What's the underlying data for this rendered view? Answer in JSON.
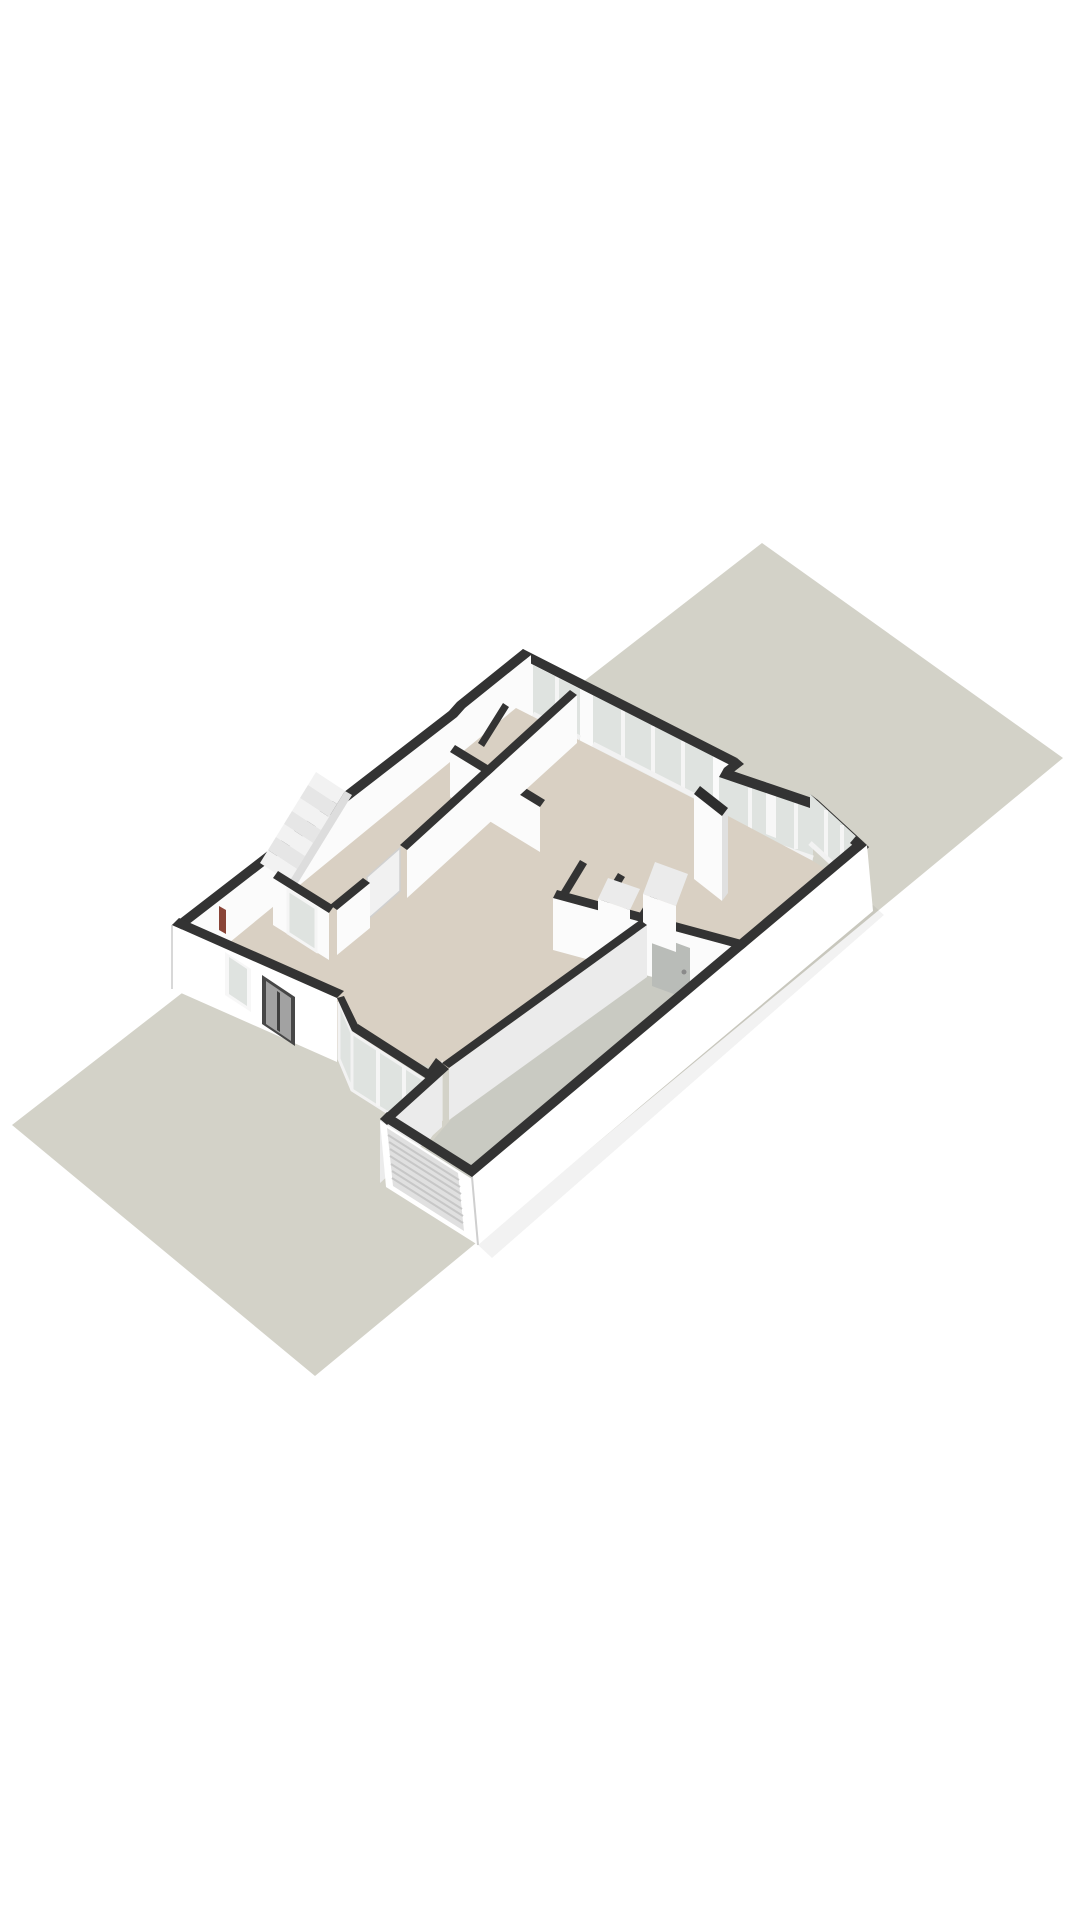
{
  "scene": {
    "kind": "isometric-3d-floorplan-render",
    "level": "ground-floor"
  },
  "colors": {
    "background": "#ffffff",
    "plot": "#d3d2c8",
    "plot_edge": "#c6c5bb",
    "wall_top": "#333333",
    "wall_top_dark": "#2d2d2d",
    "face_light": "#fbfbfb",
    "face_white": "#ffffff",
    "face_med": "#ebebeb",
    "face_shadow": "#e0e0e0",
    "floor_main": "#d9d0c3",
    "floor_sunroom": "#ddd3c5",
    "floor_garage": "#c9cac2",
    "glass": "#dfe3e0",
    "frame": "#f7f7f7",
    "sill": "#f2f2f2",
    "mullion": "#f5f5f5",
    "front_door_frame": "#474747",
    "front_door_leaf": "#a2a2a2",
    "door_slit": "#3f3f3f",
    "garage_door": "#e0e0e0",
    "garage_rib": "#c7c7c7",
    "interior_door": "#f1f1f1",
    "utility_door": "#b9bcb8",
    "radiator": "#8a4538",
    "tread_a": "#f2f2f2",
    "tread_b": "#e6e6e6",
    "stringer": "#dddddd",
    "shadow": "rgba(0,0,0,0.05)"
  }
}
